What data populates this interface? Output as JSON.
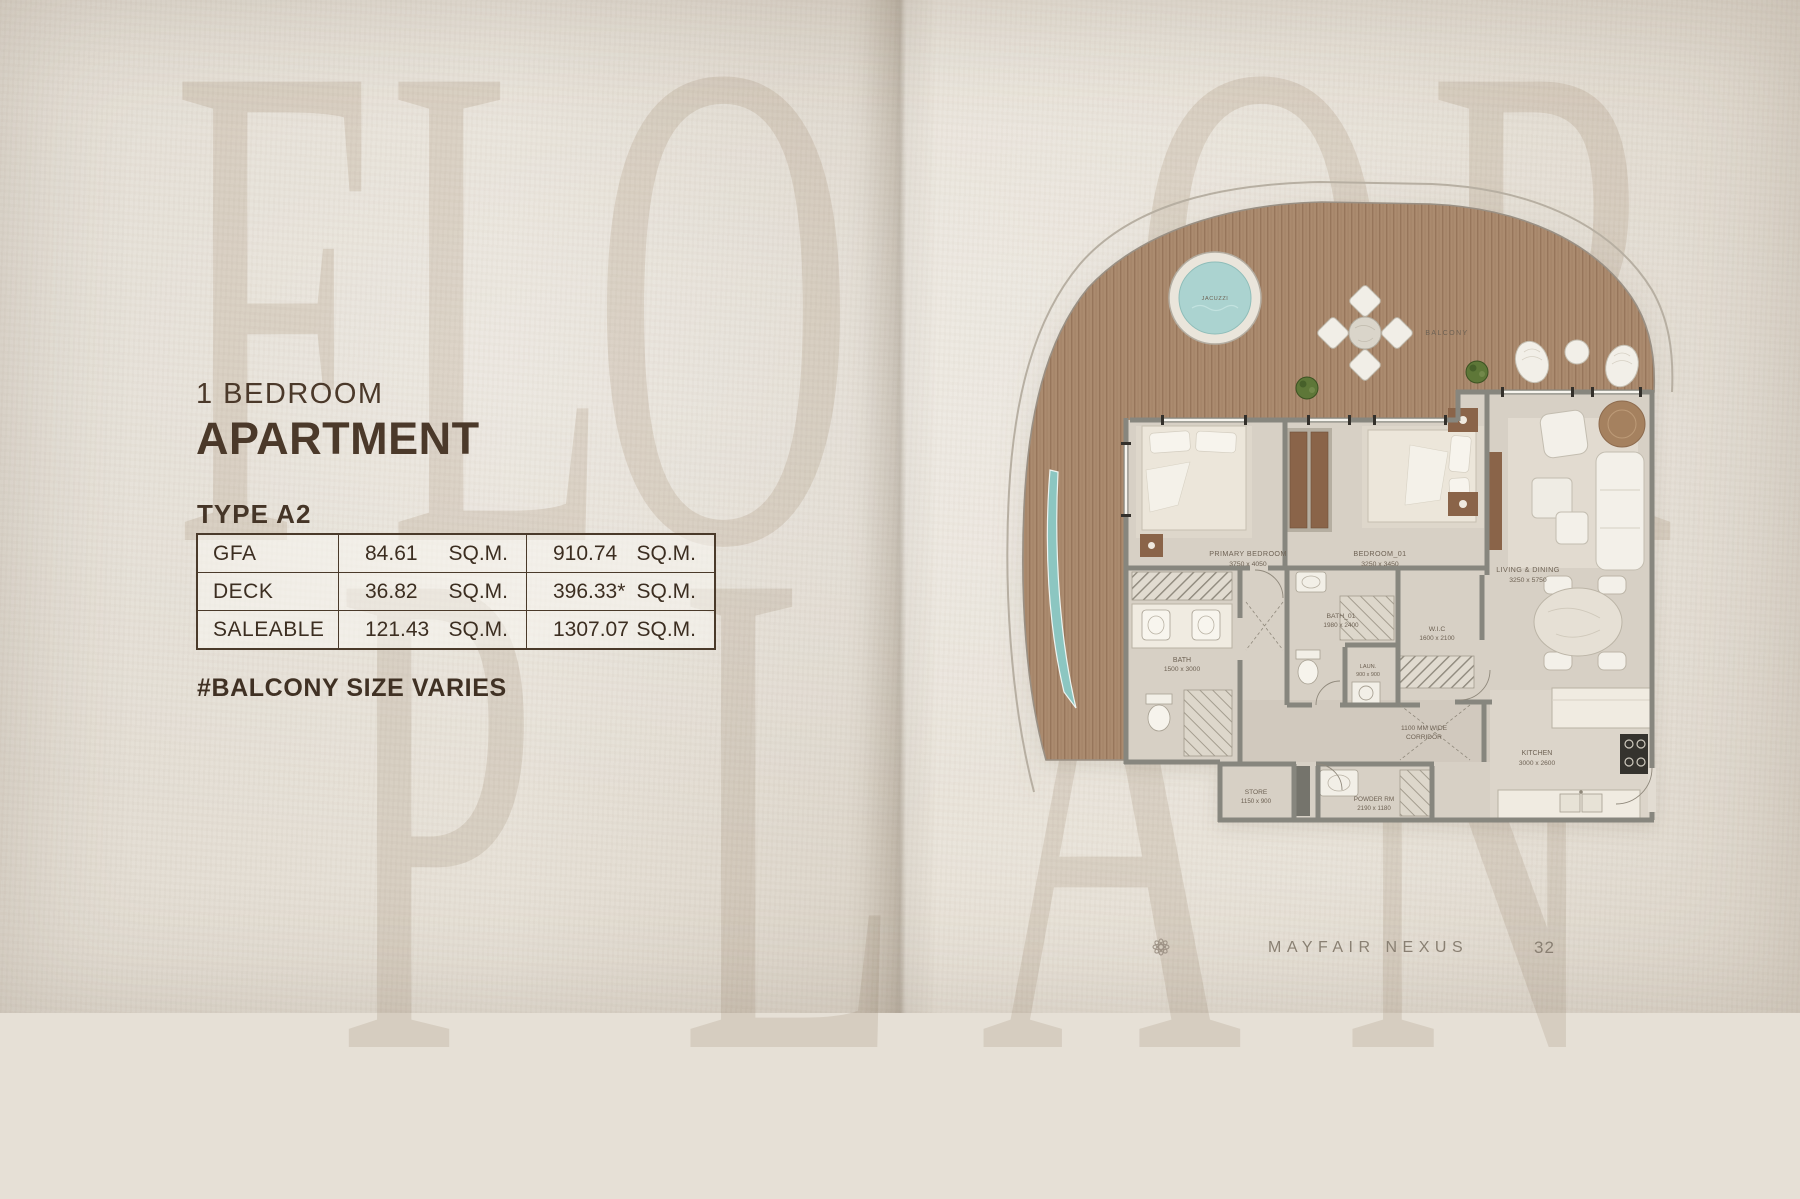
{
  "watermark": {
    "floor": [
      "F",
      "L",
      "O",
      "O",
      "R"
    ],
    "plan": [
      "P",
      "L",
      "A",
      "N"
    ]
  },
  "header": {
    "subtitle": "1 BEDROOM",
    "title": "APARTMENT",
    "type": "TYPE A2"
  },
  "table": {
    "rows": [
      {
        "label": "GFA",
        "value_sqm": "84.61",
        "unit_sqm": "SQ.M.",
        "value_alt": "910.74",
        "unit_alt": "SQ.M."
      },
      {
        "label": "DECK",
        "value_sqm": "36.82",
        "unit_sqm": "SQ.M.",
        "value_alt": "396.33*",
        "unit_alt": "SQ.M."
      },
      {
        "label": "SALEABLE",
        "value_sqm": "121.43",
        "unit_sqm": "SQ.M.",
        "value_alt": "1307.07",
        "unit_alt": "SQ.M."
      }
    ]
  },
  "note": "#BALCONY SIZE VARIES",
  "floor_plan": {
    "jacuzzi": "JACUZZI",
    "balcony": "BALCONY",
    "primary_bedroom": {
      "name": "PRIMARY BEDROOM",
      "dims": "3750 x 4050"
    },
    "bedroom_01": {
      "name": "BEDROOM_01",
      "dims": "3250 x 3450"
    },
    "living_dining": {
      "name": "LIVING & DINING",
      "dims": "3250 x 5750"
    },
    "bath": {
      "name": "BATH",
      "dims": "1500 x 3000"
    },
    "bath_01": {
      "name": "BATH_01",
      "dims": "1980 x 2400"
    },
    "laundry": {
      "name": "LAUN.",
      "dims": "900 x 900"
    },
    "wic": {
      "name": "W.I.C",
      "dims": "1600 x 2100"
    },
    "corridor": {
      "line1": "1100 MM WIDE",
      "line2": "CORRIDOR"
    },
    "store": {
      "name": "STORE",
      "dims": "1150 x 900"
    },
    "powder_room": {
      "name": "POWDER RM",
      "dims": "2190 x 1180"
    },
    "kitchen": {
      "name": "KITCHEN",
      "dims": "3000 x 2600"
    }
  },
  "footer": {
    "brand": "MAYFAIR NEXUS",
    "page": "32"
  },
  "colors": {
    "accent_brown": "#4b392a",
    "deck_wood": "#ab8b6f",
    "pool_water": "#abd3d0",
    "wall_gray": "#87867e",
    "paper": "#e6e0d6"
  }
}
